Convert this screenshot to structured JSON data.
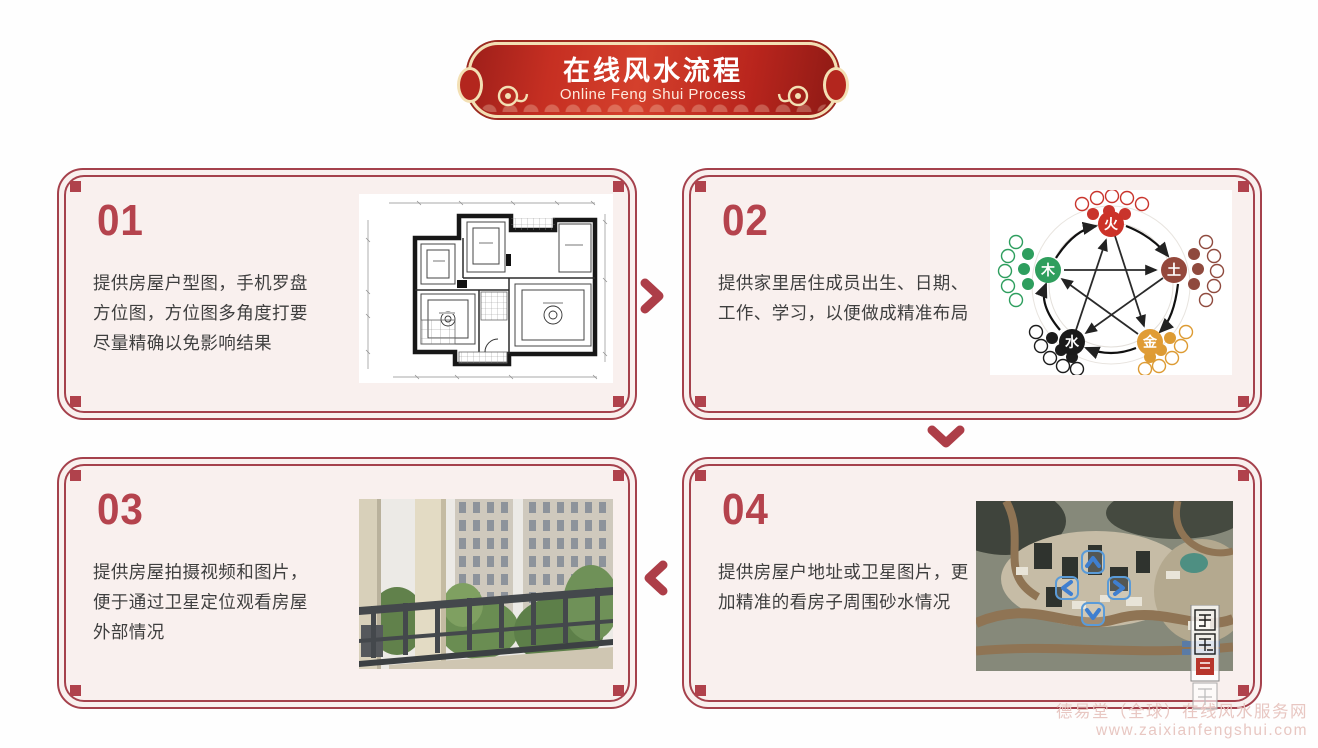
{
  "banner": {
    "title": "在线风水流程",
    "subtitle": "Online Feng Shui Process"
  },
  "steps": [
    {
      "number": "01",
      "description": "提供房屋户型图，手机罗盘方位图，方位图多角度打要尽量精确以免影响结果",
      "image": "floor-plan-blueprint"
    },
    {
      "number": "02",
      "description": "提供家里居住成员出生、日期、工作、学习，以便做成精准布局",
      "image": "five-elements-wuxing-diagram"
    },
    {
      "number": "03",
      "description": "提供房屋拍摄视频和图片，便于通过卫星定位观看房屋外部情况",
      "image": "balcony-exterior-photo"
    },
    {
      "number": "04",
      "description": "提供房屋户地址或卫星图片，更加精准的看房子周围砂水情况",
      "image": "satellite-aerial-map"
    }
  ],
  "flow_icons": {
    "step1_to_step2": "chevron-right-icon",
    "step2_to_step4": "chevron-down-icon",
    "step4_to_step3": "chevron-left-icon"
  },
  "five_elements": {
    "fire": "火",
    "earth": "土",
    "metal": "金",
    "water": "水",
    "wood": "木"
  },
  "footer": {
    "site_name": "德易堂（全球）在线风水服务网",
    "site_url": "www.zaixianfengshui.com"
  },
  "colors": {
    "accent_red": "#b5434d",
    "banner_red": "#c1272d",
    "banner_border_gold": "#f3e0b4",
    "card_bg": "#f9f0ee",
    "card_border": "#a5414c",
    "text_dark": "#3f3f3f",
    "watermark_pink": "#e8c7c2",
    "map_nav_blue": "#4a90d9"
  }
}
